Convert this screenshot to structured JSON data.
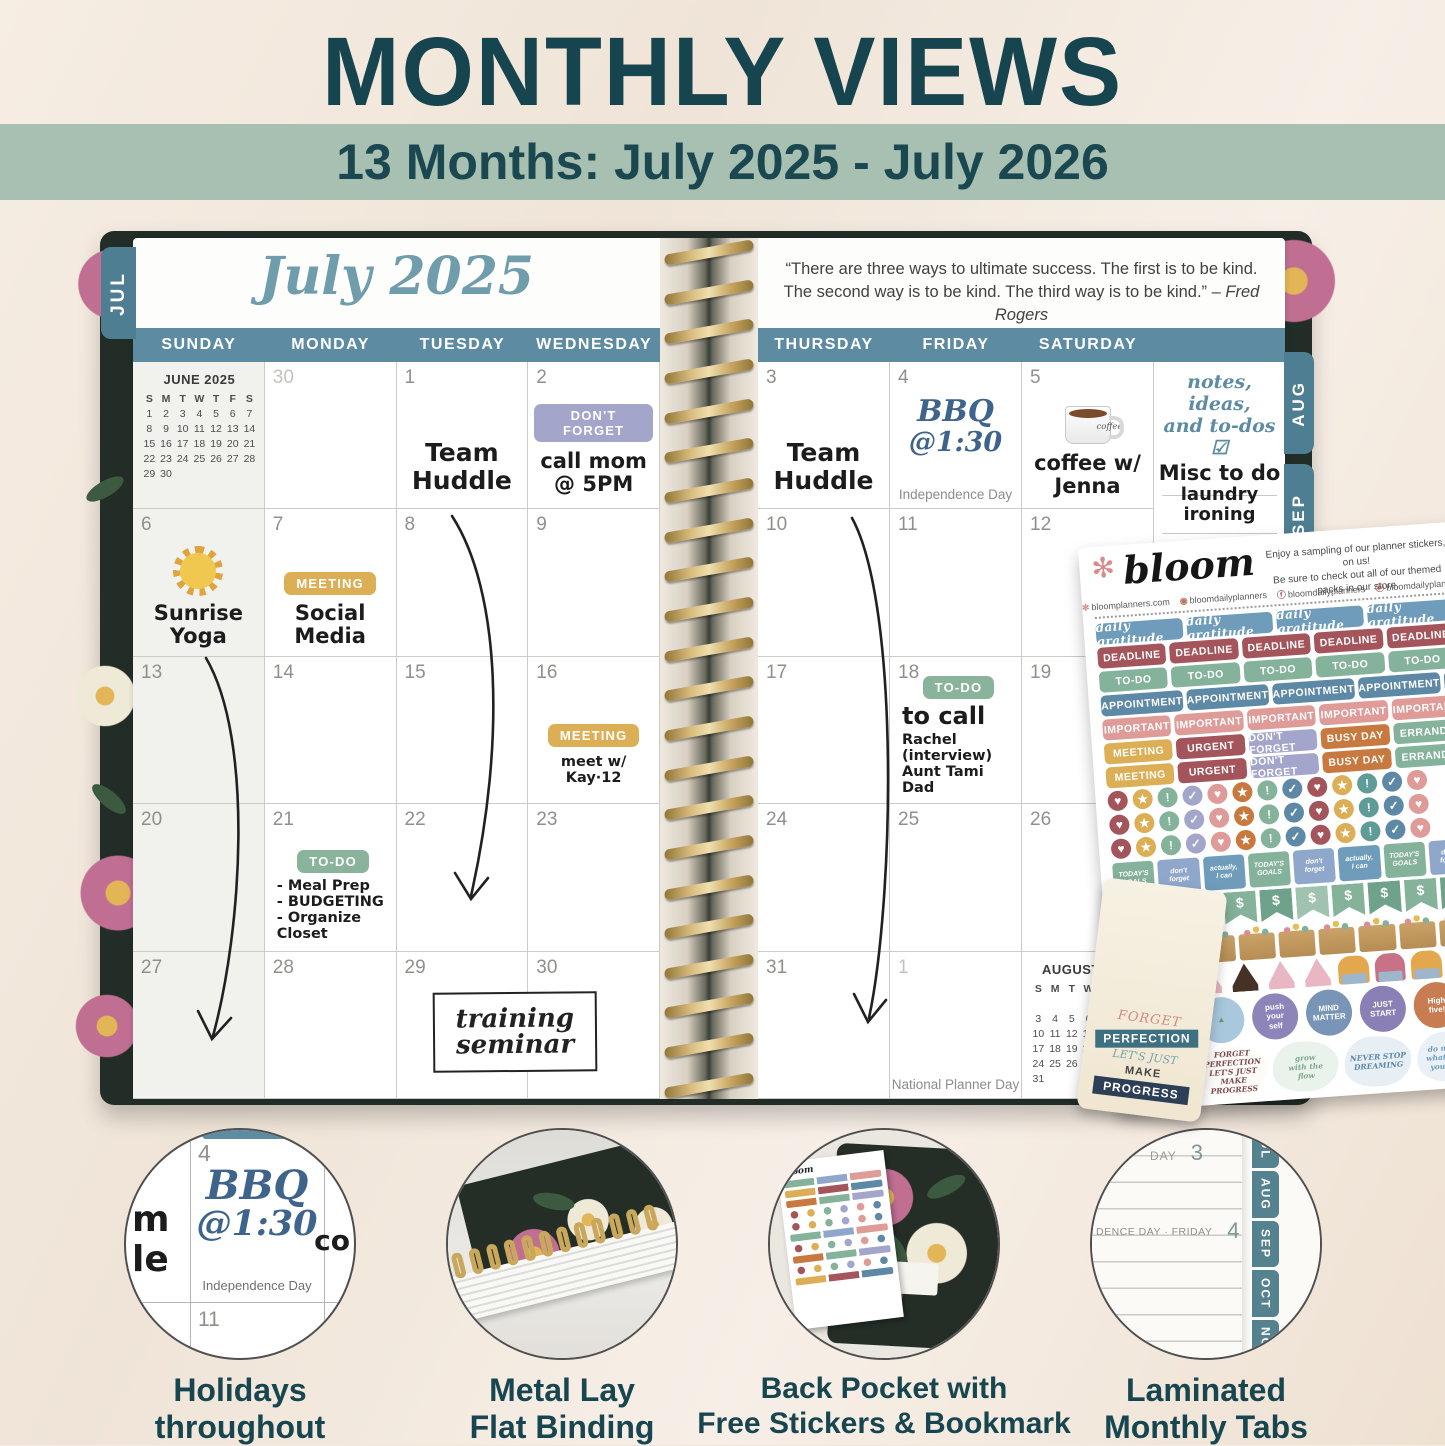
{
  "header": {
    "title": "MONTHLY VIEWS",
    "subtitle": "13 Months: July 2025 - July 2026"
  },
  "planner": {
    "left_tab": "JUL",
    "side_tabs": [
      "AUG",
      "SEP",
      "OCT",
      "NOV"
    ],
    "month_title": "July 2025",
    "left_day_headers": [
      "SUNDAY",
      "MONDAY",
      "TUESDAY",
      "WEDNESDAY"
    ],
    "right_day_headers": [
      "THURSDAY",
      "FRIDAY",
      "SATURDAY"
    ],
    "quote_line1": "“There are three ways to ultimate success. The first is to be kind.",
    "quote_line2": "The second way is to be kind. The third way is to be kind.” – ",
    "quote_author": "Fred Rogers",
    "left_days": [
      [
        "",
        "30",
        "1",
        "2"
      ],
      [
        "6",
        "7",
        "8",
        "9"
      ],
      [
        "13",
        "14",
        "15",
        "16"
      ],
      [
        "20",
        "21",
        "22",
        "23"
      ],
      [
        "27",
        "28",
        "29",
        "30"
      ]
    ],
    "right_days": [
      [
        "3",
        "4",
        "5"
      ],
      [
        "10",
        "11",
        "12"
      ],
      [
        "17",
        "18",
        "19"
      ],
      [
        "24",
        "25",
        "26"
      ],
      [
        "31",
        "1",
        ""
      ]
    ],
    "june_mini": {
      "title": "JUNE 2025",
      "letters": [
        "S",
        "M",
        "T",
        "W",
        "T",
        "F",
        "S"
      ],
      "days": [
        "1",
        "2",
        "3",
        "4",
        "5",
        "6",
        "7",
        "8",
        "9",
        "10",
        "11",
        "12",
        "13",
        "14",
        "15",
        "16",
        "17",
        "18",
        "19",
        "20",
        "21",
        "22",
        "23",
        "24",
        "25",
        "26",
        "27",
        "28",
        "29",
        "30"
      ]
    },
    "august_mini": {
      "title": "AUGUST 2025",
      "letters": [
        "S",
        "M",
        "T",
        "W",
        "T",
        "F",
        "S"
      ],
      "days": [
        "",
        "",
        "",
        "",
        "",
        "1",
        "2",
        "3",
        "4",
        "5",
        "6",
        "7",
        "8",
        "9",
        "10",
        "11",
        "12",
        "13",
        "14",
        "15",
        "16",
        "17",
        "18",
        "19",
        "20",
        "21",
        "22",
        "23",
        "24",
        "25",
        "26",
        "27",
        "28",
        "29",
        "30",
        "31"
      ]
    },
    "entries": {
      "team_huddle": "Team\nHuddle",
      "dont_forget_label": "DON'T FORGET",
      "call_mom": "call mom\n@ 5PM",
      "sunrise_yoga": "Sunrise\nYoga",
      "meeting_label": "MEETING",
      "social_media": "Social\nMedia",
      "meet_kay": "meet w/ Kay·12",
      "todo_label": "TO-DO",
      "meal_prep": "- Meal Prep\n- BUDGETING\n- Organize Closet",
      "training_seminar": "training\nseminar",
      "bbq": "BBQ",
      "bbq_time": "@1:30",
      "independence_day": "Independence Day",
      "coffee_word": "coffee",
      "coffee_jenna": "coffee w/\nJenna",
      "to_call": "to call",
      "to_call_list": "Rachel (interview)\nAunt Tami\nDad",
      "national_planner_day": "National Planner Day",
      "notes_header": "notes, ideas,\nand to-dos ☑",
      "misc_title": "Misc to do",
      "misc_items": "laundry\nironing"
    }
  },
  "sticker_sheet": {
    "brand": "bloom",
    "tagline1": "Enjoy a sampling of our planner stickers, on us!",
    "tagline2": "Be sure to check out all of our themed packs in our store.",
    "social": [
      {
        "ic": "✻",
        "icc": "#d88d8d",
        "t": "bloomplanners.com"
      },
      {
        "ic": "◉",
        "icc": "#b87a5e",
        "t": "bloomdailyplanners"
      },
      {
        "ic": "ⓕ",
        "icc": "#a4555b",
        "t": "bloomdailyplanners"
      },
      {
        "ic": "ⓟ",
        "icc": "#a4555b",
        "t": "bloomdailyplanners"
      }
    ],
    "gratitude_label": "daily gratitude",
    "deadline_label": "DEADLINE",
    "todo_label": "TO-DO",
    "appt_label": "APPOINTMENT",
    "important_label": "IMPORTANT",
    "colors": {
      "gratitude": "#6f9cbb",
      "deadline": "#a4555b",
      "todo": "#85b29a",
      "appointment": "#5d89a6",
      "important": "#de9b97"
    },
    "mixed_row": [
      {
        "t": "MEETING",
        "c": "#dcae55"
      },
      {
        "t": "URGENT",
        "c": "#a4555b"
      },
      {
        "t": "DON'T FORGET",
        "c": "#a3a5cb"
      },
      {
        "t": "BUSY DAY",
        "c": "#c8793f"
      },
      {
        "t": "ERRANDS",
        "c": "#85b29a"
      }
    ],
    "dots": [
      {
        "g": "♥",
        "c": "#a4555b"
      },
      {
        "g": "★",
        "c": "#dcae55"
      },
      {
        "g": "!",
        "c": "#85b29a"
      },
      {
        "g": "✓",
        "c": "#a3a5cb"
      },
      {
        "g": "♥",
        "c": "#de9b97"
      },
      {
        "g": "★",
        "c": "#c8793f"
      },
      {
        "g": "!",
        "c": "#85b29a"
      },
      {
        "g": "✓",
        "c": "#5d89a6"
      },
      {
        "g": "♥",
        "c": "#a4555b"
      },
      {
        "g": "★",
        "c": "#dcae55"
      },
      {
        "g": "!",
        "c": "#5f9b97"
      },
      {
        "g": "✓",
        "c": "#5d89a6"
      },
      {
        "g": "♥",
        "c": "#de9b97"
      }
    ],
    "squares": [
      {
        "t": "TODAY'S\nGOALS",
        "c": "#85b29a"
      },
      {
        "t": "don't\nforget",
        "c": "#8fa7ca"
      },
      {
        "t": "actually,\nI can",
        "c": "#6f9cbb"
      },
      {
        "t": "TODAY'S\nGOALS",
        "c": "#85b29a"
      },
      {
        "t": "don't\nforget",
        "c": "#8fa7ca"
      },
      {
        "t": "actually,\nI can",
        "c": "#6f9cbb"
      },
      {
        "t": "TODAY'S\nGOALS",
        "c": "#85b29a"
      },
      {
        "t": "don't\nforget",
        "c": "#8fa7ca"
      }
    ],
    "flags": [
      {
        "t": "$",
        "c": "#85b29a"
      },
      {
        "t": "$",
        "c": "#6fa28b"
      },
      {
        "t": "$",
        "c": "#9fc3ae"
      },
      {
        "t": "$",
        "c": "#85b29a"
      },
      {
        "t": "$",
        "c": "#6fa28b"
      },
      {
        "t": "$",
        "c": "#9fc3ae"
      },
      {
        "t": "$",
        "c": "#85b29a"
      },
      {
        "t": "$",
        "c": "#6fa28b"
      },
      {
        "t": "$",
        "c": "#85b29a"
      },
      {
        "t": "$",
        "c": "#6fa28b"
      }
    ],
    "slices": [
      {
        "c": "#e8b7c3"
      },
      {
        "c": "#463125"
      },
      {
        "c": "#e8b7c3"
      },
      {
        "c": "#463125"
      },
      {
        "c": "#e8b7c3"
      },
      {
        "c": "#e8b7c3"
      }
    ],
    "cupcakes": [
      {
        "c": "#e3a84e"
      },
      {
        "c": "#c77287"
      },
      {
        "c": "#e3a84e"
      },
      {
        "c": "#c77287"
      }
    ],
    "rounds": [
      {
        "t": "☼",
        "c": "#e9b64a",
        "fg": "#f8edc9"
      },
      {
        "t": "▲",
        "c": "#a9c8dd",
        "fg": "#6f9468"
      },
      {
        "t": "push\nyour\nself",
        "c": "#8d85b9",
        "fg": "#ffffff"
      },
      {
        "t": "MIND\nMATTER",
        "c": "#7894b6",
        "fg": "#ffffff"
      },
      {
        "t": "JUST\nSTART",
        "c": "#8a80b5",
        "fg": "#ffffff"
      },
      {
        "t": "High\nfive!",
        "c": "#c77c52",
        "fg": "#ffffff"
      }
    ],
    "scripts": [
      {
        "t": "",
        "c": "#9a93c2",
        "bg": "#cfcbe3"
      },
      {
        "t": "FORGET\nPERFECTION\nLET'S JUST\nMAKE\nPROGRESS",
        "c": "#7b4a4e",
        "bg": "#fdfbf7"
      },
      {
        "t": "grow\nwith the\nflow",
        "c": "#7fa98b",
        "bg": "#eaf2ec"
      },
      {
        "t": "NEVER STOP\nDREAMING",
        "c": "#5b88a8",
        "bg": "#e7eff5"
      },
      {
        "t": "do more of\nwhat makes\nyou happy",
        "c": "#6f9cbb",
        "bg": "#e9f1f6"
      }
    ]
  },
  "bookmark": {
    "l1": "FORGET",
    "l2": "PERFECTION",
    "l3": "LET'S JUST",
    "l4": "MAKE",
    "l5": "PROGRESS"
  },
  "features": {
    "captions": [
      "Holidays\nthroughout",
      "Metal Lay\nFlat Binding",
      "Back Pocket with\nFree Stickers & Bookmark",
      "Laminated\nMonthly Tabs"
    ],
    "c1": {
      "day": "4",
      "bbq": "BBQ",
      "time": "@1:30",
      "holiday": "Independence Day",
      "day2": "11",
      "day3": "12",
      "frag_left": "m\nle",
      "frag_right": "co"
    },
    "c4": {
      "tabs": [
        "JUL",
        "AUG",
        "SEP",
        "OCT",
        "NOV"
      ],
      "top": "DAY",
      "top_num": "3",
      "mid": "DENCE DAY · FRIDAY",
      "mid_num": "4"
    }
  }
}
